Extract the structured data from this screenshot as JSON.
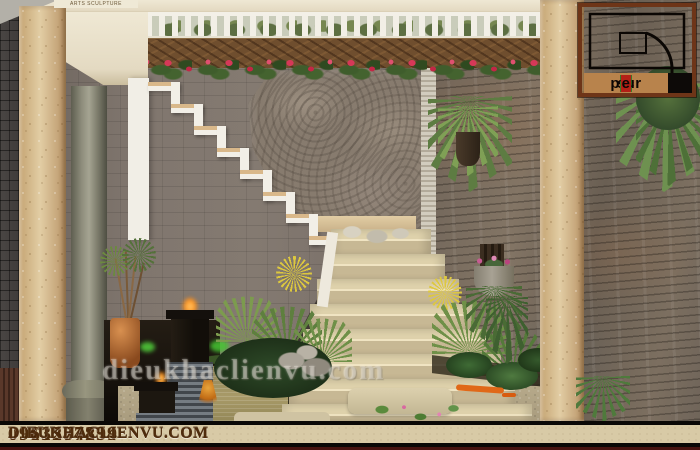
{
  "branding": {
    "arts_label": "ARTS SCULPTURE",
    "watermark": "dieukhaclienvu.com",
    "logo": {
      "s1": "sc",
      "s2": "u",
      "s3": "ptur",
      "s4": "e",
      "accent_green": "#3a7a28",
      "accent_red": "#b32016",
      "frame_color": "#6e3518",
      "strip_color": "#b8834c"
    }
  },
  "footer": {
    "bar_color": "#d8caa6",
    "text_color": "#4f2c0c",
    "items": [
      {
        "type": "phone",
        "text": "0913574894"
      },
      {
        "type": "website",
        "text": "DIEUKHACLIENVU.COM"
      },
      {
        "type": "phone",
        "text": "0961287239"
      },
      {
        "type": "website",
        "text": "DIEUKHACLIENVU.COM"
      }
    ]
  },
  "scene": {
    "description": "3D interior courtyard render: white zigzag staircase with wooden treads against a grey tiled wall with a carved leaf stone relief, slate ledgestone wall with hanging plants on the right, carved wooden lattice and white balustrade with red flowers on top, koi pond with black cube fountains, palms, rocks and beige lower steps",
    "colors": {
      "wall_gray": "#7e746c",
      "stone_wall": "#786c5f",
      "pillar_tan": "#dcc49c",
      "stair_white": "#f2efe7",
      "tread_wood": "#d9b88a",
      "step_beige": "#d9cba4",
      "pond_olive": "#9a8f62",
      "flower_red": "#d63858",
      "foliage_green": "#5d7c42"
    }
  }
}
